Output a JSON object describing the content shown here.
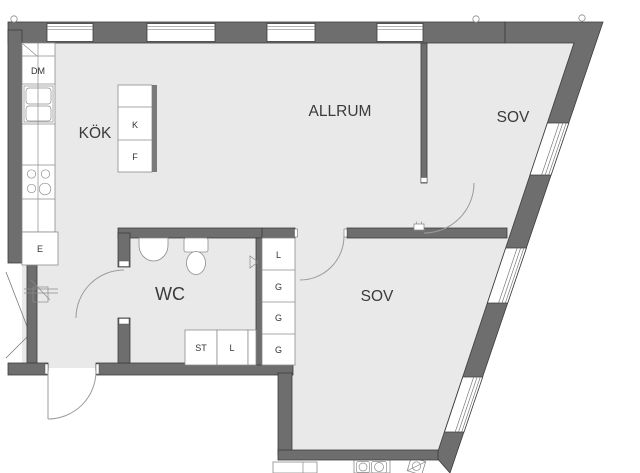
{
  "plan": {
    "rooms": {
      "kitchen": {
        "label": "KÖK"
      },
      "living_room": {
        "label": "ALLRUM"
      },
      "bedroom_upper": {
        "label": "SOV"
      },
      "bedroom_lower": {
        "label": "SOV"
      },
      "wc": {
        "label": "WC"
      }
    },
    "fixtures": {
      "dishwasher": {
        "label": "DM"
      },
      "fridge": {
        "label": "K"
      },
      "freezer": {
        "label": "F"
      },
      "electrical_closet": {
        "label": "E"
      },
      "cleaning_closet": {
        "label": "ST"
      },
      "linen_closet_wc": {
        "label": "L"
      },
      "linen_closet_hall": {
        "label": "L"
      },
      "wardrobe_1": {
        "label": "G"
      },
      "wardrobe_2": {
        "label": "G"
      },
      "wardrobe_3": {
        "label": "G"
      }
    },
    "colors": {
      "wall": "#6e6e6e",
      "floor": "#e9e9e9",
      "line": "#8c8c8c",
      "arc": "#9b9b9b",
      "label": "#3a3a3a"
    }
  }
}
